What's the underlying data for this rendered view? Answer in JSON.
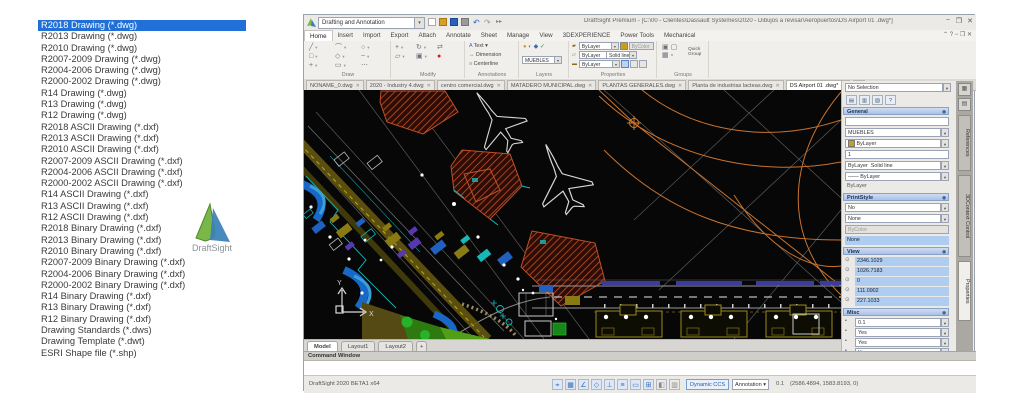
{
  "formats": {
    "items": [
      "R2018 Drawing (*.dwg)",
      "R2013 Drawing (*.dwg)",
      "R2010 Drawing (*.dwg)",
      "R2007-2009 Drawing (*.dwg)",
      "R2004-2006 Drawing (*.dwg)",
      "R2000-2002 Drawing (*.dwg)",
      "R14 Drawing (*.dwg)",
      "R13 Drawing (*.dwg)",
      "R12 Drawing (*.dwg)",
      "R2018 ASCII Drawing (*.dxf)",
      "R2013 ASCII Drawing (*.dxf)",
      "R2010 ASCII Drawing (*.dxf)",
      "R2007-2009 ASCII Drawing (*.dxf)",
      "R2004-2006 ASCII Drawing (*.dxf)",
      "R2000-2002 ASCII Drawing (*.dxf)",
      "R14 ASCII Drawing (*.dxf)",
      "R13 ASCII Drawing (*.dxf)",
      "R12 ASCII Drawing (*.dxf)",
      "R2018 Binary Drawing (*.dxf)",
      "R2013 Binary Drawing (*.dxf)",
      "R2010 Binary Drawing (*.dxf)",
      "R2007-2009 Binary Drawing (*.dxf)",
      "R2004-2006 Binary Drawing (*.dxf)",
      "R2000-2002 Binary Drawing (*.dxf)",
      "R14 Binary Drawing (*.dxf)",
      "R13 Binary Drawing (*.dxf)",
      "R12 Binary Drawing (*.dxf)",
      "Drawing Standards (*.dws)",
      "Drawing Template (*.dwt)",
      "ESRI Shape file (*.shp)"
    ]
  },
  "logo": {
    "text": "DraftSight"
  },
  "win": {
    "workspace": "Drafting and Annotation",
    "title": "DraftSight Premium - [C:\\00 - Clientes\\Dassault Systemes\\2020 - Dibujos a revisar\\Aeropuertos\\DS Airport 01 .dwg*]",
    "titlebar": {
      "undo": "↶",
      "redo": "↷",
      "arrows": "▸▸",
      "min": "−",
      "max": "❐",
      "close": "✕"
    },
    "menu": [
      "Home",
      "Insert",
      "Import",
      "Export",
      "Attach",
      "Annotate",
      "Sheet",
      "Manage",
      "View",
      "3DEXPERIENCE",
      "Power Tools",
      "Mechanical"
    ],
    "menu_right": "⌃  ?  −  ❐  ✕",
    "ribbon": {
      "draw": {
        "label": "Draw",
        "glyphs": [
          "╱",
          "⌒",
          "○",
          "□",
          "◇",
          "~",
          "+",
          "▭",
          "⋯"
        ]
      },
      "modify": {
        "label": "Modify",
        "glyphs": [
          "+",
          "↻",
          "⇄",
          "▱",
          "▣",
          "●"
        ]
      },
      "annotations": {
        "label": "Annotations",
        "items": [
          "Text",
          "Dimension",
          "Centerline"
        ],
        "glyphs": [
          "A",
          "↔",
          "≡"
        ]
      },
      "layers": {
        "label": "Layers",
        "current": "MUEBLES",
        "glyphs": [
          "●",
          "◐",
          "◆",
          "✓"
        ]
      },
      "properties": {
        "label": "Properties",
        "color": "ByLayer",
        "bycolor": "ByColor",
        "linestyle": "ByLayer",
        "linestyle2": "Solid line",
        "lineweight": "ByLayer",
        "rowicons": [
          "▰",
          "▱",
          "▬"
        ]
      },
      "groups": {
        "label": "Groups",
        "button": "Quick Group",
        "glyphs": [
          "▣",
          "▢",
          "▦",
          "▫"
        ]
      }
    },
    "doctabs": {
      "tabs": [
        "NONAME_0.dwg",
        "2020 - Industry 4.dwg",
        "centro comercial.dwg",
        "MATADERO MUNICIPAL.dwg",
        "PLANTAS GENERALES.dwg",
        "Planta de industrias lacteas.dwg",
        "DS Airport 01 .dwg*"
      ]
    },
    "panel": {
      "selector": "No Selection",
      "toolbar_glyphs": [
        "▤",
        "▥",
        "▧",
        "?"
      ],
      "strip_glyphs": [
        "▦",
        "▤"
      ],
      "row_icon": "⊙",
      "misc_icon": "▪",
      "general": {
        "label": "General",
        "layer": "MUEBLES",
        "color": "ByLayer",
        "scale": "1",
        "linestyle": "ByLayer",
        "linestyle2": "Solid line",
        "lineweight": "ByLayer",
        "extra": "ByLayer"
      },
      "printstyle": {
        "label": "PrintStyle",
        "rows": [
          "No",
          "None",
          "ByColor",
          "None"
        ]
      },
      "view": {
        "label": "View",
        "values": [
          "2346.1029",
          "1026.7183",
          "0",
          "111.0902",
          "227.1033"
        ]
      },
      "misc": {
        "label": "Misc",
        "values": [
          "0.1",
          "Yes",
          "Yes",
          "Yes"
        ]
      },
      "vtabs": [
        "References",
        "3DContext Control",
        "Properties"
      ]
    },
    "modelbar": {
      "tabs": [
        "Model",
        "Layout1",
        "Layout2"
      ],
      "plus": "+"
    },
    "command": {
      "header": "Command Window"
    },
    "status": {
      "product": "DraftSight 2020 BETA1  x64",
      "glyphs": [
        "⌖",
        "▦",
        "∠",
        "◇",
        "⊥",
        "≡",
        "▭",
        "⊞",
        "◧",
        "▥"
      ],
      "ccs": "Dynamic CCS",
      "annotation": "Annotation",
      "scale": "0.1",
      "coords": "(2586.4894, 1583.8193, 0)"
    }
  },
  "canvas": {
    "axis_x": "X",
    "axis_y": "Y"
  },
  "colors": {
    "selection": "#2170d8",
    "hatch_red": "#c05028",
    "orange": "#c87430",
    "cyan": "#18b8b8",
    "blue": "#1868c8",
    "green": "#28b828",
    "olive": "#8a7a14"
  }
}
